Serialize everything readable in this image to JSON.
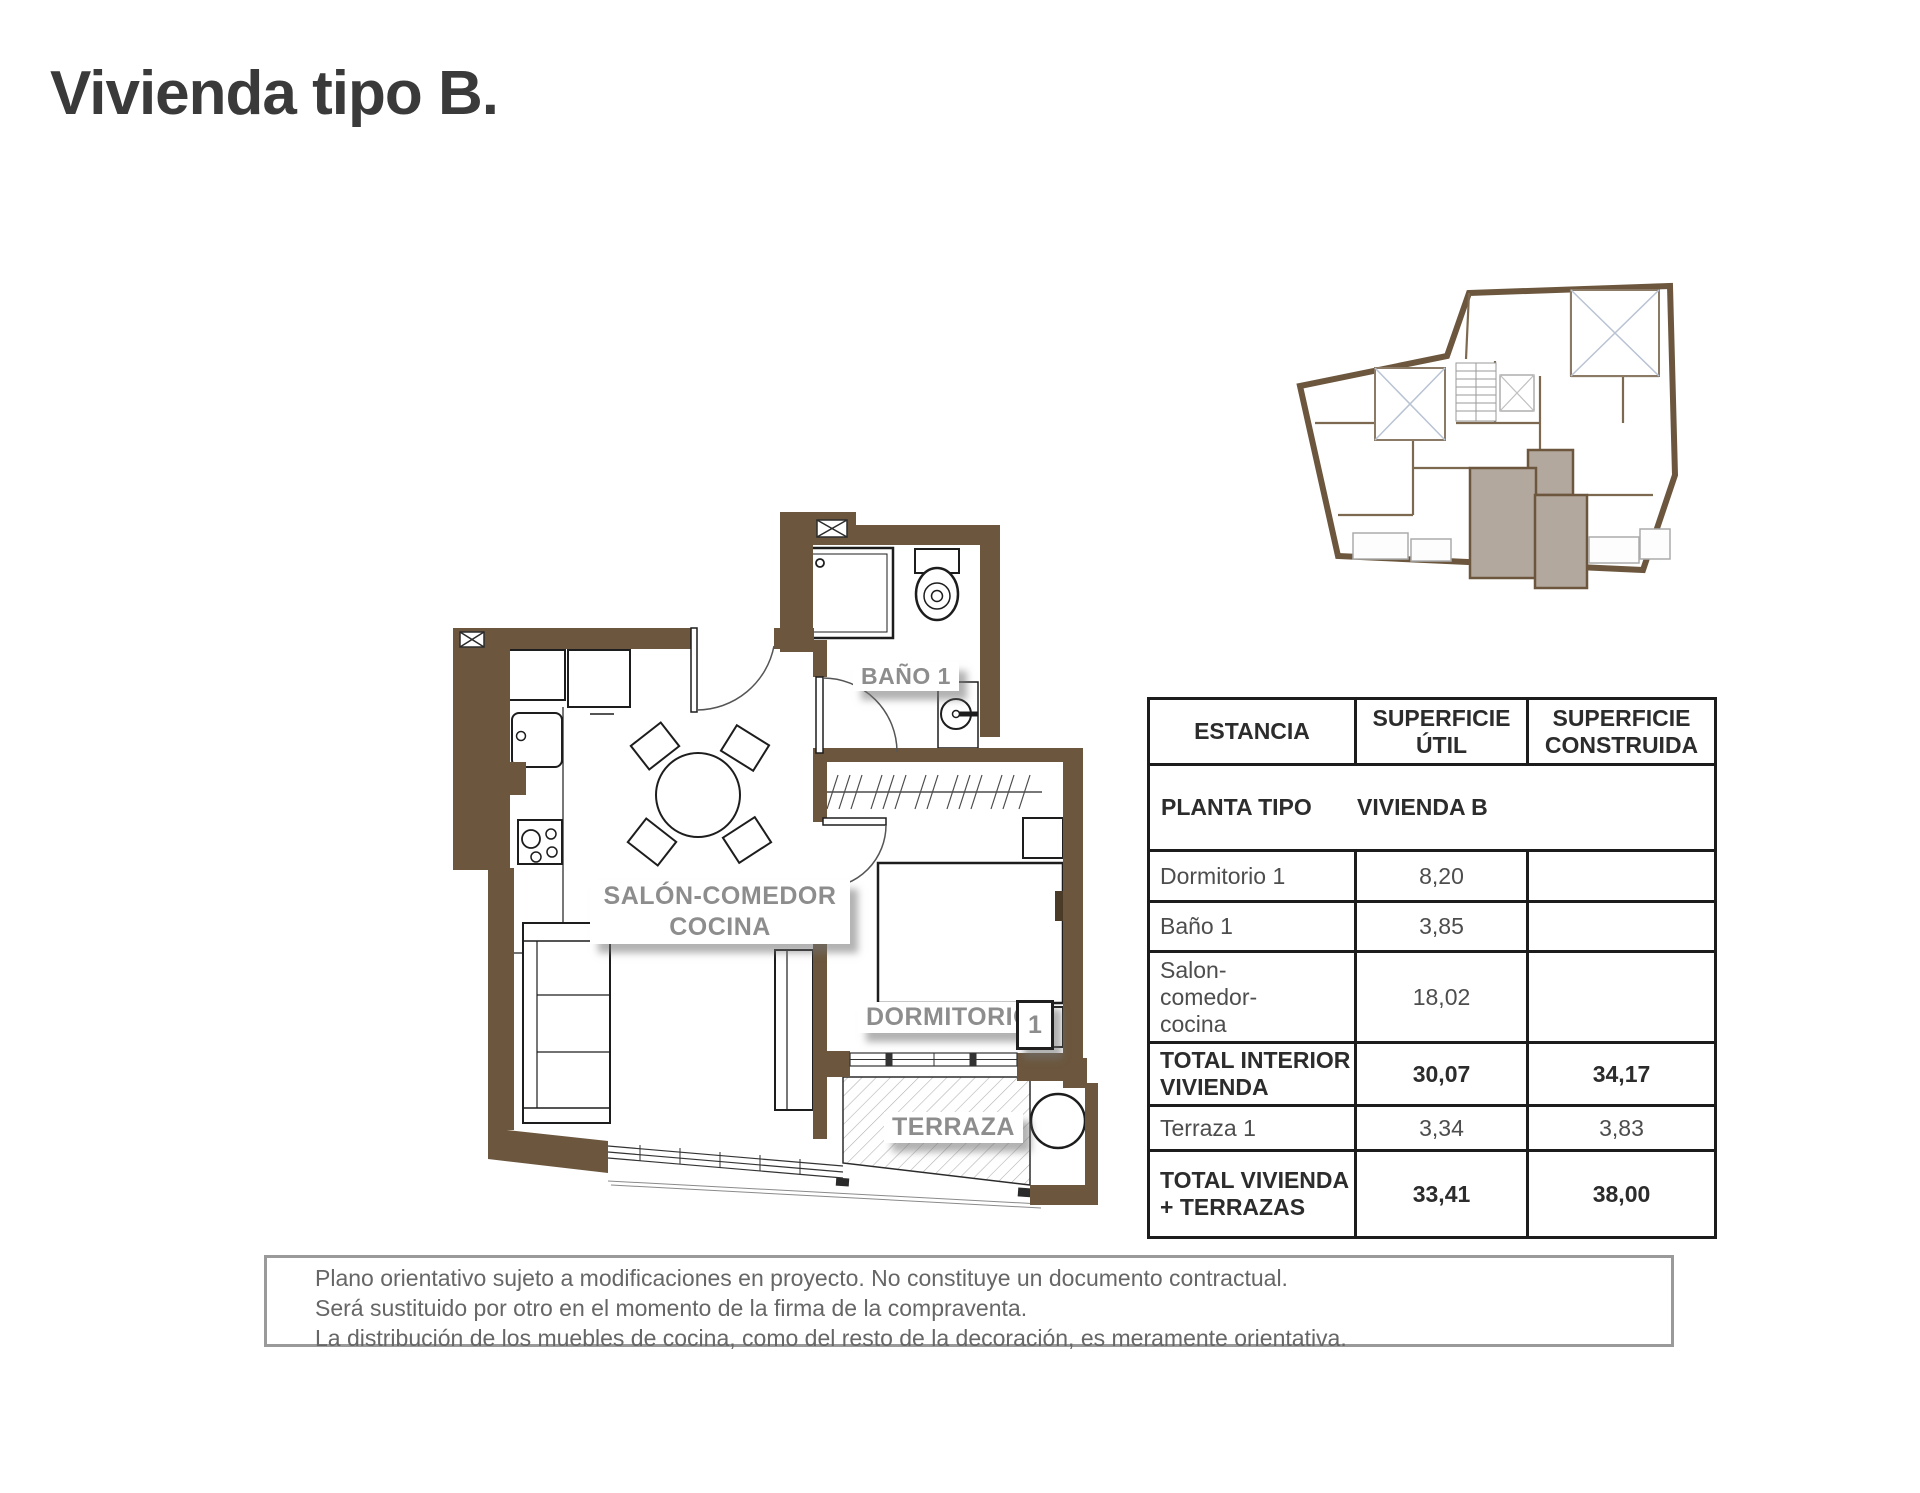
{
  "page": {
    "title": "Vivienda tipo B."
  },
  "plan": {
    "labels": {
      "bathroom": "BAÑO 1",
      "living": "SALÓN-COMEDOR\nCOCINA",
      "bedroom": "DORMITORIO",
      "bedroom_number": "1",
      "terrace": "TERRAZA"
    },
    "colors": {
      "wall": "#6C573E",
      "unit_highlight": "#B3A89D",
      "label_gray": "#8D8D8D"
    }
  },
  "table": {
    "headers": {
      "col1": "ESTANCIA",
      "col2": "SUPERFICIE\nÚTIL",
      "col3": "SUPERFICIE\nCONSTRUIDA"
    },
    "subrow": {
      "left": "PLANTA TIPO",
      "right": "VIVIENDA B"
    },
    "rows": [
      {
        "name": "Dormitorio 1",
        "util": "8,20",
        "built": ""
      },
      {
        "name": "Baño 1",
        "util": "3,85",
        "built": ""
      },
      {
        "name": "Salon-\ncomedor-\ncocina",
        "util": "18,02",
        "built": ""
      },
      {
        "name": "TOTAL INTERIOR\nVIVIENDA",
        "util": "30,07",
        "built": "34,17"
      },
      {
        "name": "Terraza 1",
        "util": "3,34",
        "built": "3,83"
      },
      {
        "name": "TOTAL VIVIENDA\n+ TERRAZAS",
        "util": "33,41",
        "built": "38,00"
      }
    ]
  },
  "disclaimer": {
    "line1": "Plano orientativo sujeto a modificaciones en proyecto. No constituye un documento contractual.",
    "line2": "Será sustituido por otro en el momento de la firma de la compraventa.",
    "line3": "La distribución de los muebles de cocina, como del resto de la decoración, es meramente orientativa."
  }
}
